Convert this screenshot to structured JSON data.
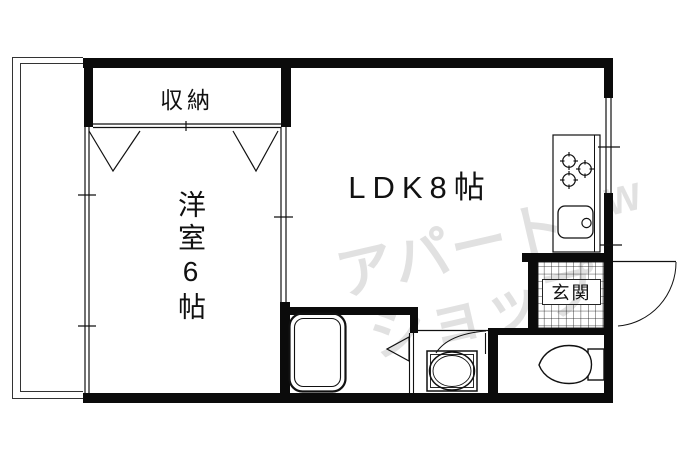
{
  "floor_plan": {
    "rooms": {
      "closet": {
        "label": "収納"
      },
      "western_room": {
        "label": "洋室6帖"
      },
      "ldk": {
        "label": "LDK8帖"
      },
      "entrance": {
        "label": "玄関"
      }
    },
    "fixtures": [
      "balcony",
      "closet-doors",
      "sliding-partition",
      "bathtub",
      "bathroom-door",
      "washing-machine",
      "washroom-door",
      "toilet",
      "entrance-tiles",
      "entrance-door",
      "gas-stove-3-burner",
      "kitchen-sink",
      "kitchen-counter",
      "windows"
    ]
  },
  "watermark": {
    "line1": "アパート",
    "line2": "ショップ",
    "mark": "W"
  },
  "colors": {
    "wall": "#0b0b0b",
    "line": "#111111",
    "background": "#ffffff",
    "watermark": "#e1e1e1"
  }
}
